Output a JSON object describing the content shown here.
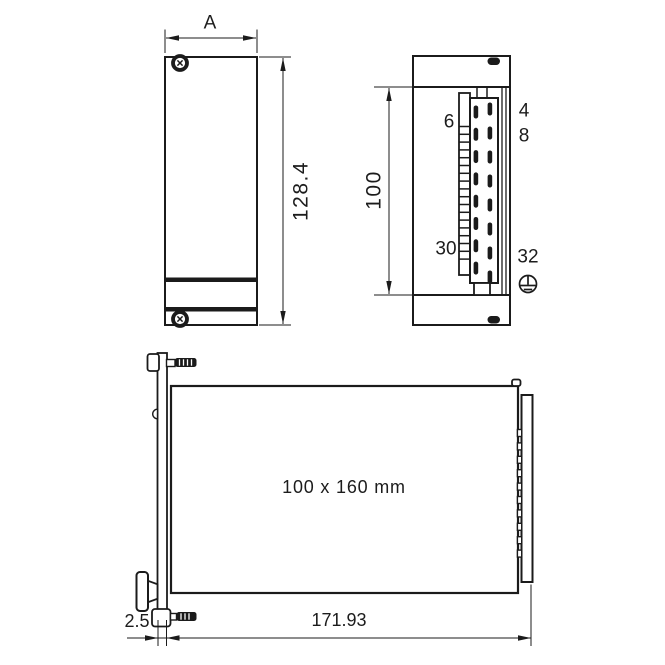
{
  "drawing": {
    "title": "rack module dimension drawing",
    "colors": {
      "line": "#1b1b1b",
      "background": "#ffffff"
    },
    "front": {
      "width_label": "A",
      "height_label": "128.4"
    },
    "side": {
      "height_label": "100",
      "pins": {
        "r6": "6",
        "r30": "30",
        "r4": "4",
        "r8": "8",
        "r32": "32"
      }
    },
    "depth": {
      "board_label": "100 x 160 mm",
      "depth_label": "171.93",
      "panel_thickness_label": "2.5"
    },
    "icons": {
      "front_screws": "torx-screw-icon",
      "side_screws": "oval-slot-icon",
      "ground": "protective-earth-icon",
      "handle": "extraction-knob-icon"
    }
  }
}
